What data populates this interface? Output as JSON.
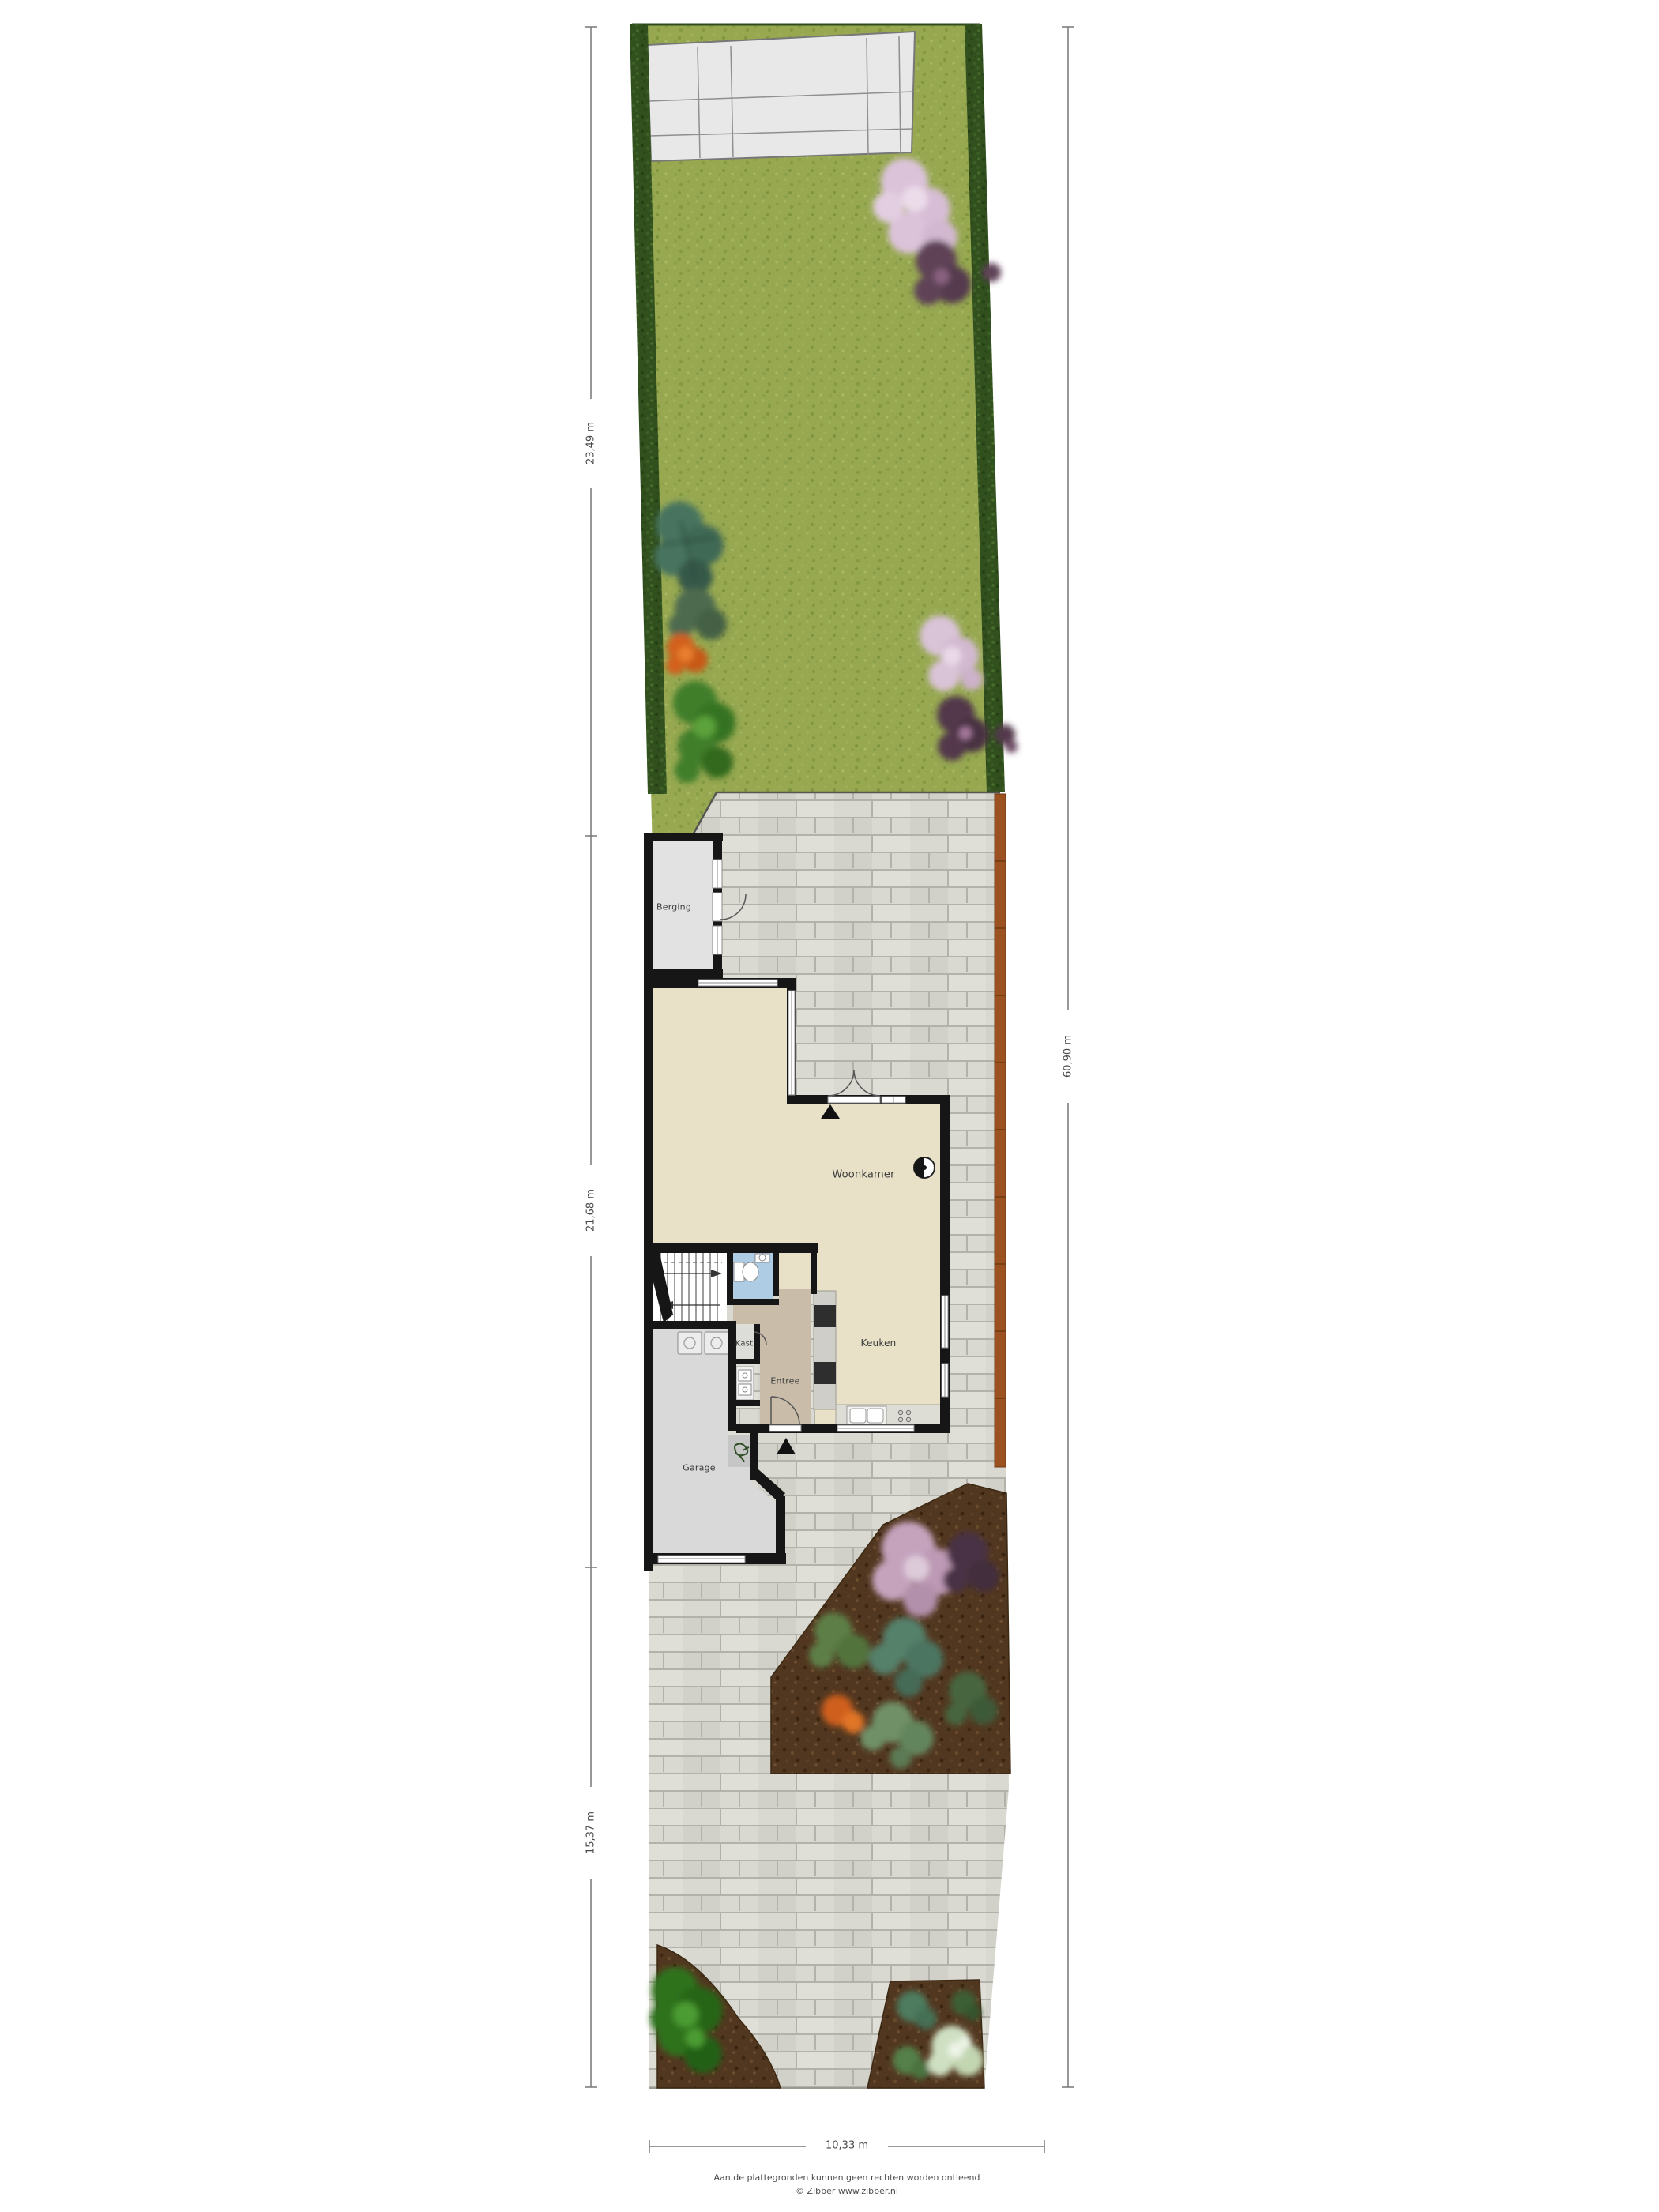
{
  "plan": {
    "rooms": {
      "berging": "Berging",
      "woonkamer": "Woonkamer",
      "keuken": "Keuken",
      "entree": "Entree",
      "kast": "Kast",
      "garage": "Garage"
    },
    "dimensions": {
      "left_top": "23,49 m",
      "left_middle": "21,68 m",
      "left_bottom": "15,37 m",
      "right": "60,90 m",
      "bottom": "10,33 m"
    },
    "footer": {
      "line1": "Aan de plattegronden kunnen geen rechten worden ontleend",
      "line2": "© Zibber www.zibber.nl"
    },
    "palette": {
      "grass": "#97a851",
      "hedge": "#31501e",
      "brick": "#dad9d1",
      "mortar": "#b3b2aa",
      "soil": "#523720",
      "fence": "#9c5220",
      "wall": "#161616",
      "floor_living": "#e8e1c8",
      "floor_entree": "#c9bca9",
      "floor_garage": "#d9d9d9",
      "floor_berging": "#e2e2e2",
      "floor_toilet": "#aecde4",
      "patio_tile": "#e8e8e8"
    }
  }
}
